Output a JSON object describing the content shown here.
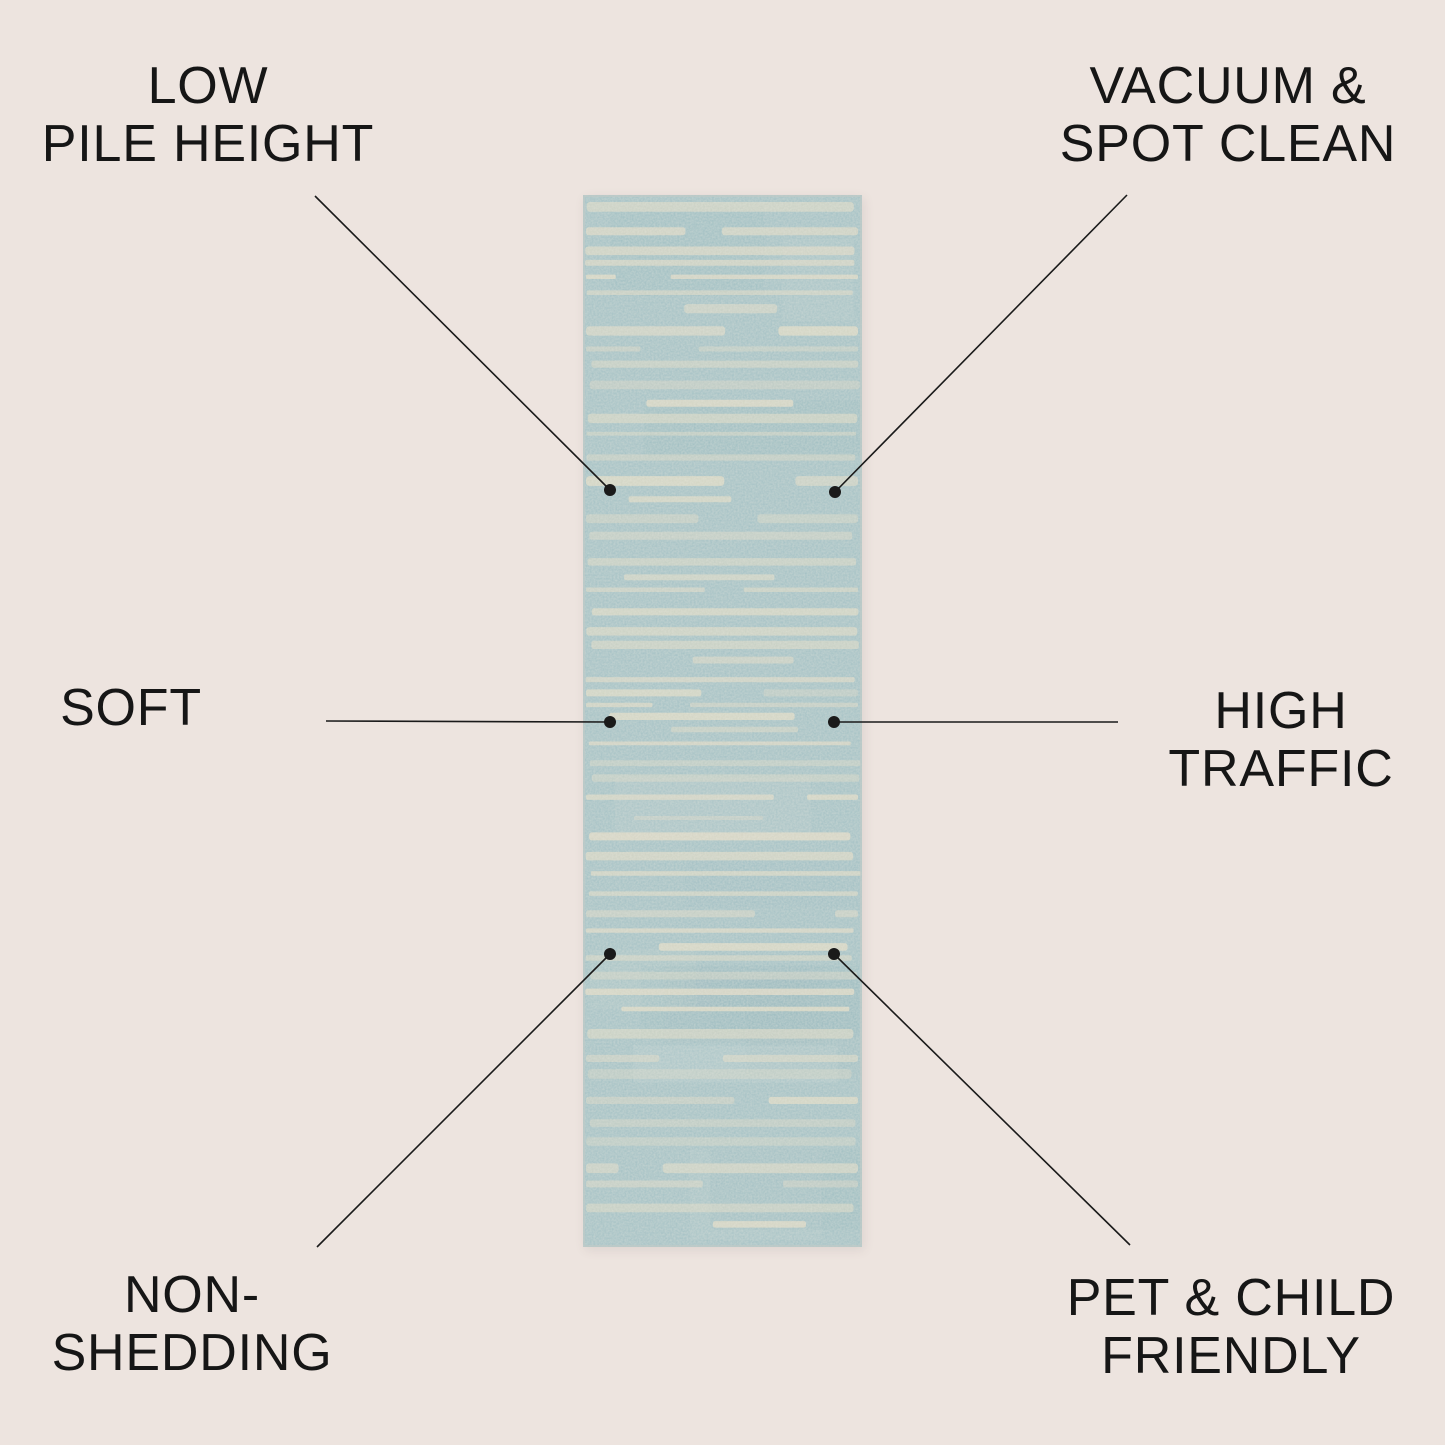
{
  "colors": {
    "background": "#EDE4DF",
    "text": "#161616",
    "line": "#1a1a1a",
    "rug_base": "#A2C0C4",
    "rug_base_dark": "#8FB4BA",
    "rug_stripe": "#DDD8C3",
    "rug_edge": "#BFCBC8"
  },
  "features": [
    {
      "id": "low-pile-height",
      "position": "top-left",
      "lines": [
        "LOW",
        "PILE HEIGHT"
      ]
    },
    {
      "id": "vacuum-spot-clean",
      "position": "top-right",
      "lines": [
        "VACUUM &",
        "SPOT CLEAN"
      ]
    },
    {
      "id": "soft",
      "position": "middle-left",
      "lines": [
        "SOFT"
      ]
    },
    {
      "id": "high-traffic",
      "position": "middle-right",
      "lines": [
        "HIGH",
        "TRAFFIC"
      ]
    },
    {
      "id": "non-shedding",
      "position": "bottom-left",
      "lines": [
        "NON-",
        "SHEDDING"
      ]
    },
    {
      "id": "pet-child-friendly",
      "position": "bottom-right",
      "lines": [
        "PET & CHILD",
        "FRIENDLY"
      ]
    }
  ]
}
